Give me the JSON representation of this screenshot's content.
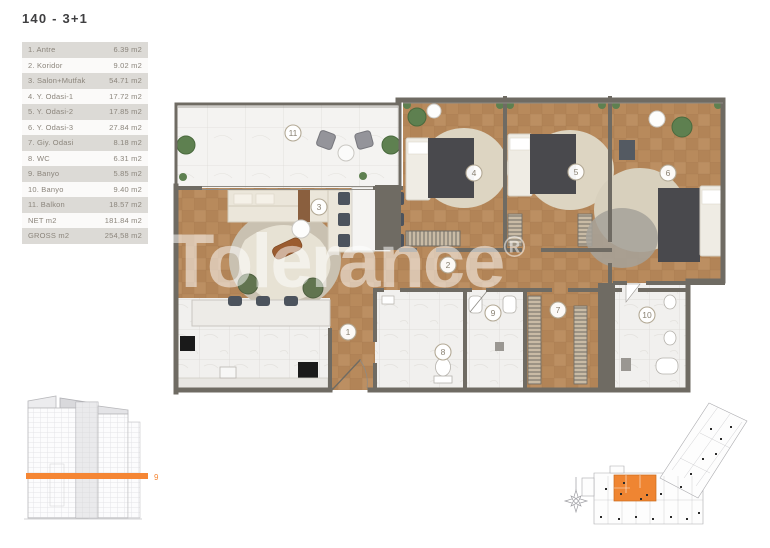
{
  "header": {
    "title": "140 - 3+1"
  },
  "area_table": {
    "rows": [
      {
        "label": "1. Antre",
        "value": "6.39 m2"
      },
      {
        "label": "2. Koridor",
        "value": "9.02 m2"
      },
      {
        "label": "3. Salon+Mutfak",
        "value": "54.71 m2"
      },
      {
        "label": "4. Y. Odasi-1",
        "value": "17.72 m2"
      },
      {
        "label": "5. Y. Odasi-2",
        "value": "17.85 m2"
      },
      {
        "label": "6. Y. Odasi-3",
        "value": "27.84 m2"
      },
      {
        "label": "7. Giy. Odasi",
        "value": "8.18 m2"
      },
      {
        "label": "8. WC",
        "value": "6.31 m2"
      },
      {
        "label": "9. Banyo",
        "value": "5.85 m2"
      },
      {
        "label": "10. Banyo",
        "value": "9.40 m2"
      },
      {
        "label": "11. Balkon",
        "value": "18.57 m2"
      },
      {
        "label": "NET m2",
        "value": "181.84 m2"
      },
      {
        "label": "GROSS m2",
        "value": "254,58 m2"
      }
    ]
  },
  "plan": {
    "watermark": "Tolerance",
    "watermark_reg": "®",
    "markers": [
      "1",
      "2",
      "3",
      "4",
      "5",
      "6",
      "7",
      "8",
      "9",
      "10",
      "11"
    ]
  },
  "elevation": {
    "floor_label": "9"
  },
  "colors": {
    "accent": "#F58634",
    "wall": "#6F6B63"
  }
}
